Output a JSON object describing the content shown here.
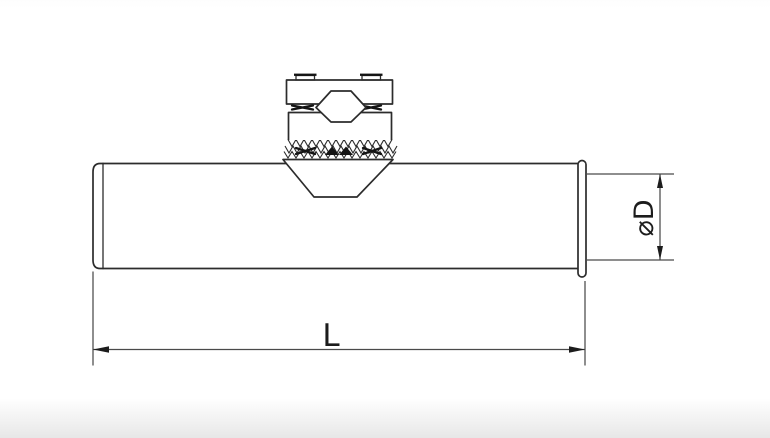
{
  "drawing": {
    "labels": {
      "length": "L",
      "diameter": "⌀D"
    },
    "colors": {
      "background": "#ffffff",
      "object_line": "#2c2c2c",
      "dimension_line": "#4a4a4a",
      "arrow_fill": "#1c1c1c",
      "bottom_fade": "#e7e7e7"
    }
  }
}
